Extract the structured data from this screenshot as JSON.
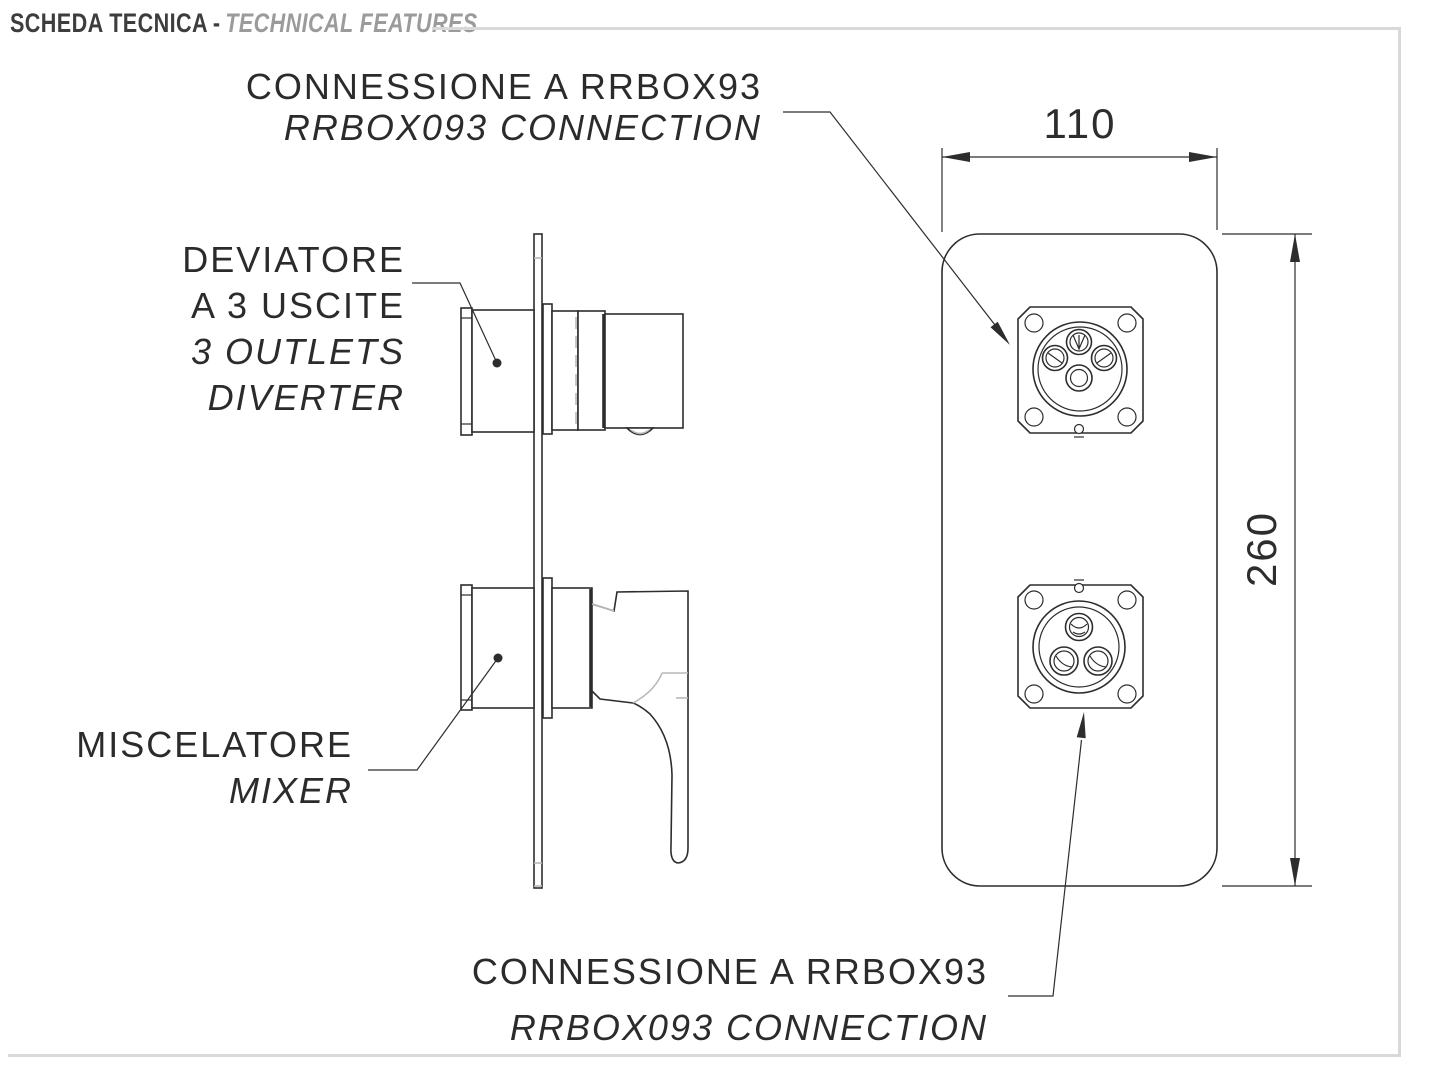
{
  "header": {
    "title_it": "SCHEDA TECNICA",
    "separator": "-",
    "title_en": "TECHNICAL FEATURES"
  },
  "labels": {
    "connection_top": {
      "line1": "CONNESSIONE A RRBOX93",
      "line2": "RRBOX093 CONNECTION"
    },
    "diverter": {
      "line1": "DEVIATORE",
      "line2": "A 3 USCITE",
      "line3": "3 OUTLETS",
      "line4": "DIVERTER"
    },
    "mixer": {
      "line1": "MISCELATORE",
      "line2": "MIXER"
    },
    "connection_bottom": {
      "line1": "CONNESSIONE A RRBOX93",
      "line2": "RRBOX093 CONNECTION"
    }
  },
  "dimensions": {
    "width": "110",
    "height": "260"
  },
  "colors": {
    "line": "#2d2d2d",
    "accent_gray": "#b5b9bc",
    "frame_gray": "#d9d9d9",
    "header_dark": "#3d3d3d",
    "header_gray": "#9b9b9b",
    "background": "#ffffff"
  }
}
